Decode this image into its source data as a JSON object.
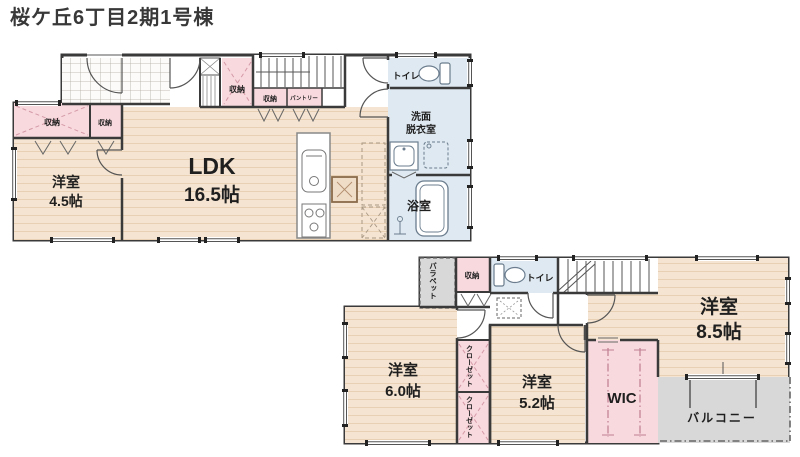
{
  "title": "桜ケ丘6丁目2期1号棟",
  "colors": {
    "wood": "#f5e4d1",
    "closet_pink": "#f8d9de",
    "wet_blue": "#dfe9f1",
    "balcony_gray": "#d8d8d8",
    "wall": "#3a3a3a"
  },
  "floor1": {
    "ldk": {
      "name": "LDK",
      "size": "16.5帖"
    },
    "western_room": {
      "name": "洋室",
      "size": "4.5帖"
    },
    "bathroom": {
      "name": "浴室"
    },
    "washroom": {
      "line1": "洗面",
      "line2": "脱衣室"
    },
    "toilet": {
      "name": "トイレ"
    },
    "storage_a": {
      "name": "収納"
    },
    "storage_b": {
      "name": "収納"
    },
    "storage_hall": {
      "name": "収納"
    },
    "storage_understair": {
      "name": "収納"
    },
    "pantry": {
      "name": "パントリー"
    }
  },
  "floor2": {
    "western_room_85": {
      "name": "洋室",
      "size": "8.5帖"
    },
    "western_room_60": {
      "name": "洋室",
      "size": "6.0帖"
    },
    "western_room_52": {
      "name": "洋室",
      "size": "5.2帖"
    },
    "wic": {
      "name": "WIC"
    },
    "balcony": {
      "name": "バルコニー"
    },
    "toilet": {
      "name": "トイレ"
    },
    "storage": {
      "name": "収納"
    },
    "closet_upper": {
      "name": "クローゼット"
    },
    "closet_lower": {
      "name": "クローゼット"
    },
    "parapet": {
      "name": "パラペット"
    }
  }
}
